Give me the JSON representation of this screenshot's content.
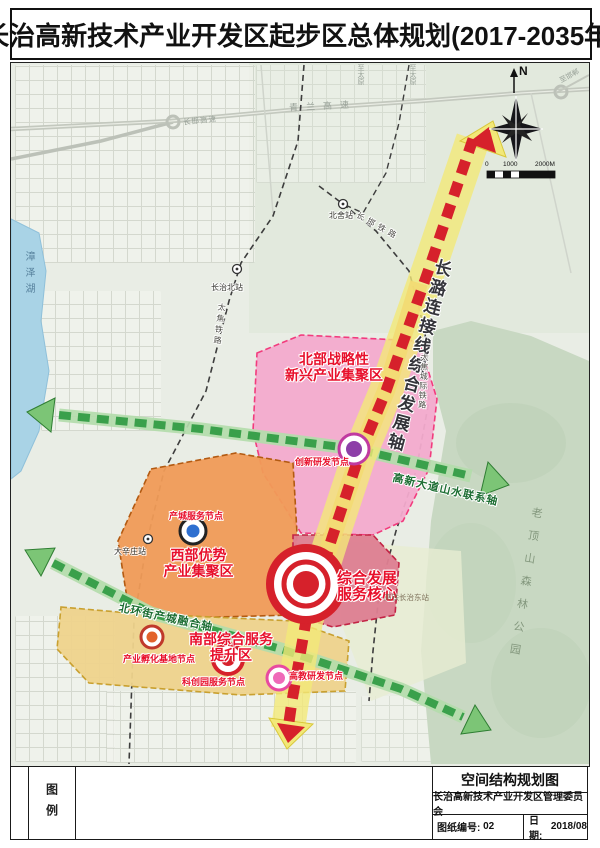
{
  "title": "长治高新技术产业开发区起步区总体规划(2017-2035年)",
  "compass": {
    "north_label": "N"
  },
  "scale_bar": {
    "l0": "0",
    "l1": "1000",
    "l2": "2000M"
  },
  "colors": {
    "axis_red": "#d6212b",
    "axis_yellow": "#f2e878",
    "axis_green": "#3aa04b",
    "zone_north_pink": "#f3abce",
    "zone_west_orange": "#f09b57",
    "zone_south_yellow": "#eed38c",
    "zone_core_rose": "#de7f92",
    "label_red": "#e8102c",
    "lake_blue": "#a9d3e6",
    "forest_green": "#c8d8c2"
  },
  "map": {
    "axes": {
      "main": {
        "label": "长潞连接线综合发展轴"
      },
      "east_west": {
        "label": "高新大道山水联系轴"
      },
      "south": {
        "label": "北环街产城融合轴"
      }
    },
    "zones": {
      "north": {
        "line1": "北部战略性",
        "line2": "新兴产业集聚区"
      },
      "west": {
        "line1": "西部优势",
        "line2": "产业集聚区"
      },
      "south": {
        "line1": "南部综合服务",
        "line2": "提升区"
      },
      "core": {
        "line1": "综合发展",
        "line2": "服务核心"
      }
    },
    "nodes": {
      "innovation": "创新研发节点",
      "industry_city": "产城服务节点",
      "incubator": "产业孵化基地节点",
      "sci_park": "科创园服务节点",
      "education": "高教研发节点"
    },
    "stations": {
      "beishe": "北舍站",
      "changzhi_north": "长治北站",
      "daxinzhuang": "大辛庄站",
      "changzhi_east": "高铁长治东站"
    },
    "roads": {
      "qinglan_expwy": "青兰高速",
      "changhan_expwy": "长邯高速",
      "taijiao_railway": "太焦铁路",
      "changhan_railway": "长邯铁路",
      "taijiao_intercity": "太焦城际铁路",
      "to_taiyuan_a": "至太原",
      "to_taiyuan_b": "至太原",
      "to_handan": "至邯郸"
    },
    "places": {
      "lake": "漳泽湖",
      "forest": "老顶山森林公园"
    }
  },
  "legend": {
    "label": "图例"
  },
  "title_block": {
    "drawing_title": "空间结构规划图",
    "organization": "长治高新技术产业开发区管理委员会",
    "sheet_no_label": "图纸编号:",
    "sheet_no": "02",
    "date_label": "日期:",
    "date": "2018/08"
  }
}
